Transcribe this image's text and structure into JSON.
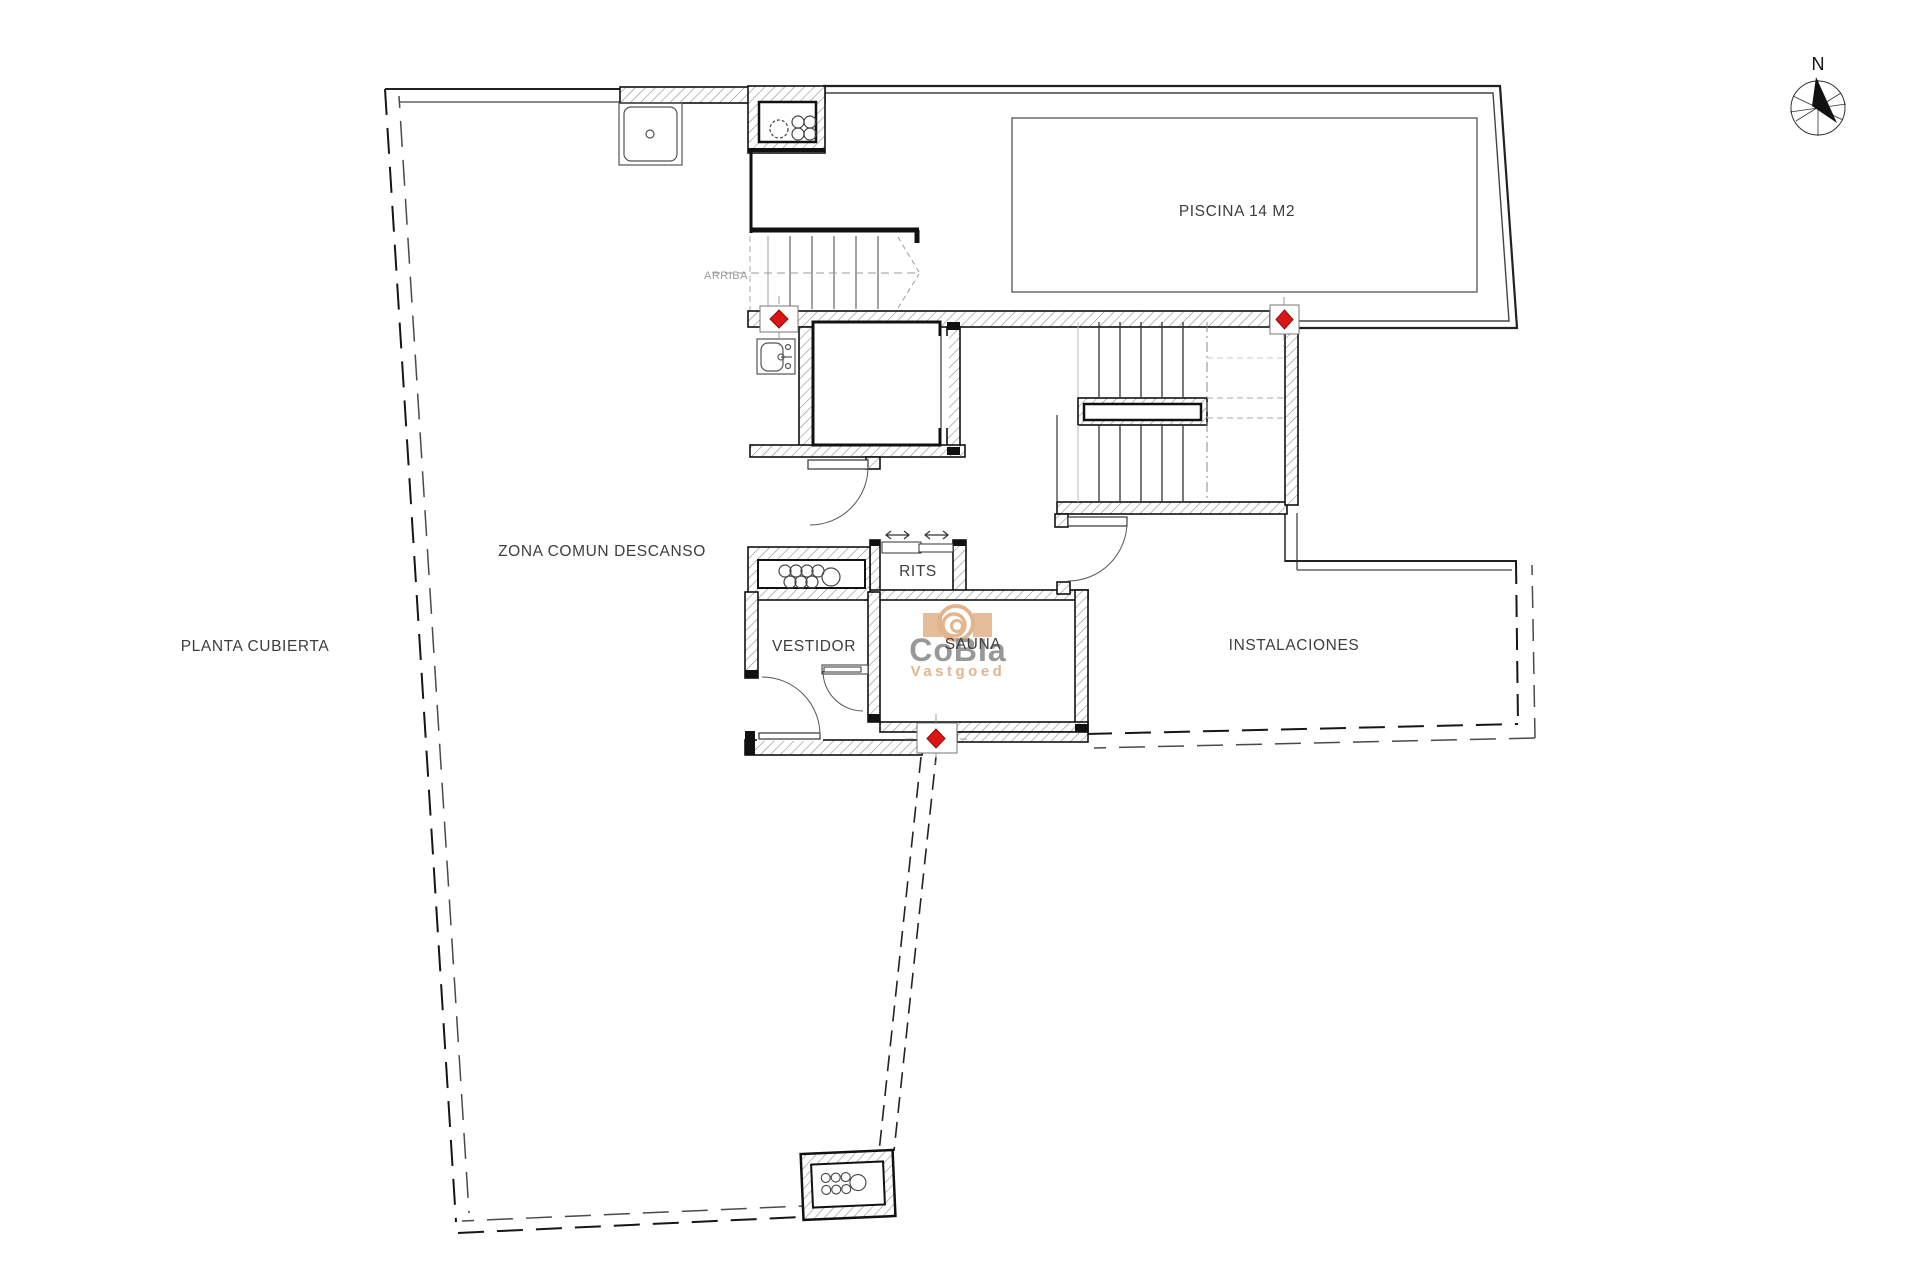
{
  "title": "PLANTA CUBIERTA",
  "labels": {
    "planta_cubierta": "PLANTA CUBIERTA",
    "zona_comun": "ZONA COMUN DESCANSO",
    "piscina": "PISCINA 14 M2",
    "arriba": "ARRIBA",
    "rits": "RITS",
    "vestidor": "VESTIDOR",
    "sauna": "SAUNA",
    "instalaciones": "INSTALACIONES",
    "north": "N"
  },
  "watermark": {
    "brand": "CoBIa",
    "subtitle": "Vastgoed",
    "accent_color": "#e2b288",
    "text_color": "#8d8d8d"
  },
  "colors": {
    "background": "#ffffff",
    "line": "#1a1a1a",
    "hatch": "#8f8f8f",
    "marker_red": "#dc1414",
    "muted_text": "#9b9b9b",
    "label_text": "#3d3d3d"
  }
}
